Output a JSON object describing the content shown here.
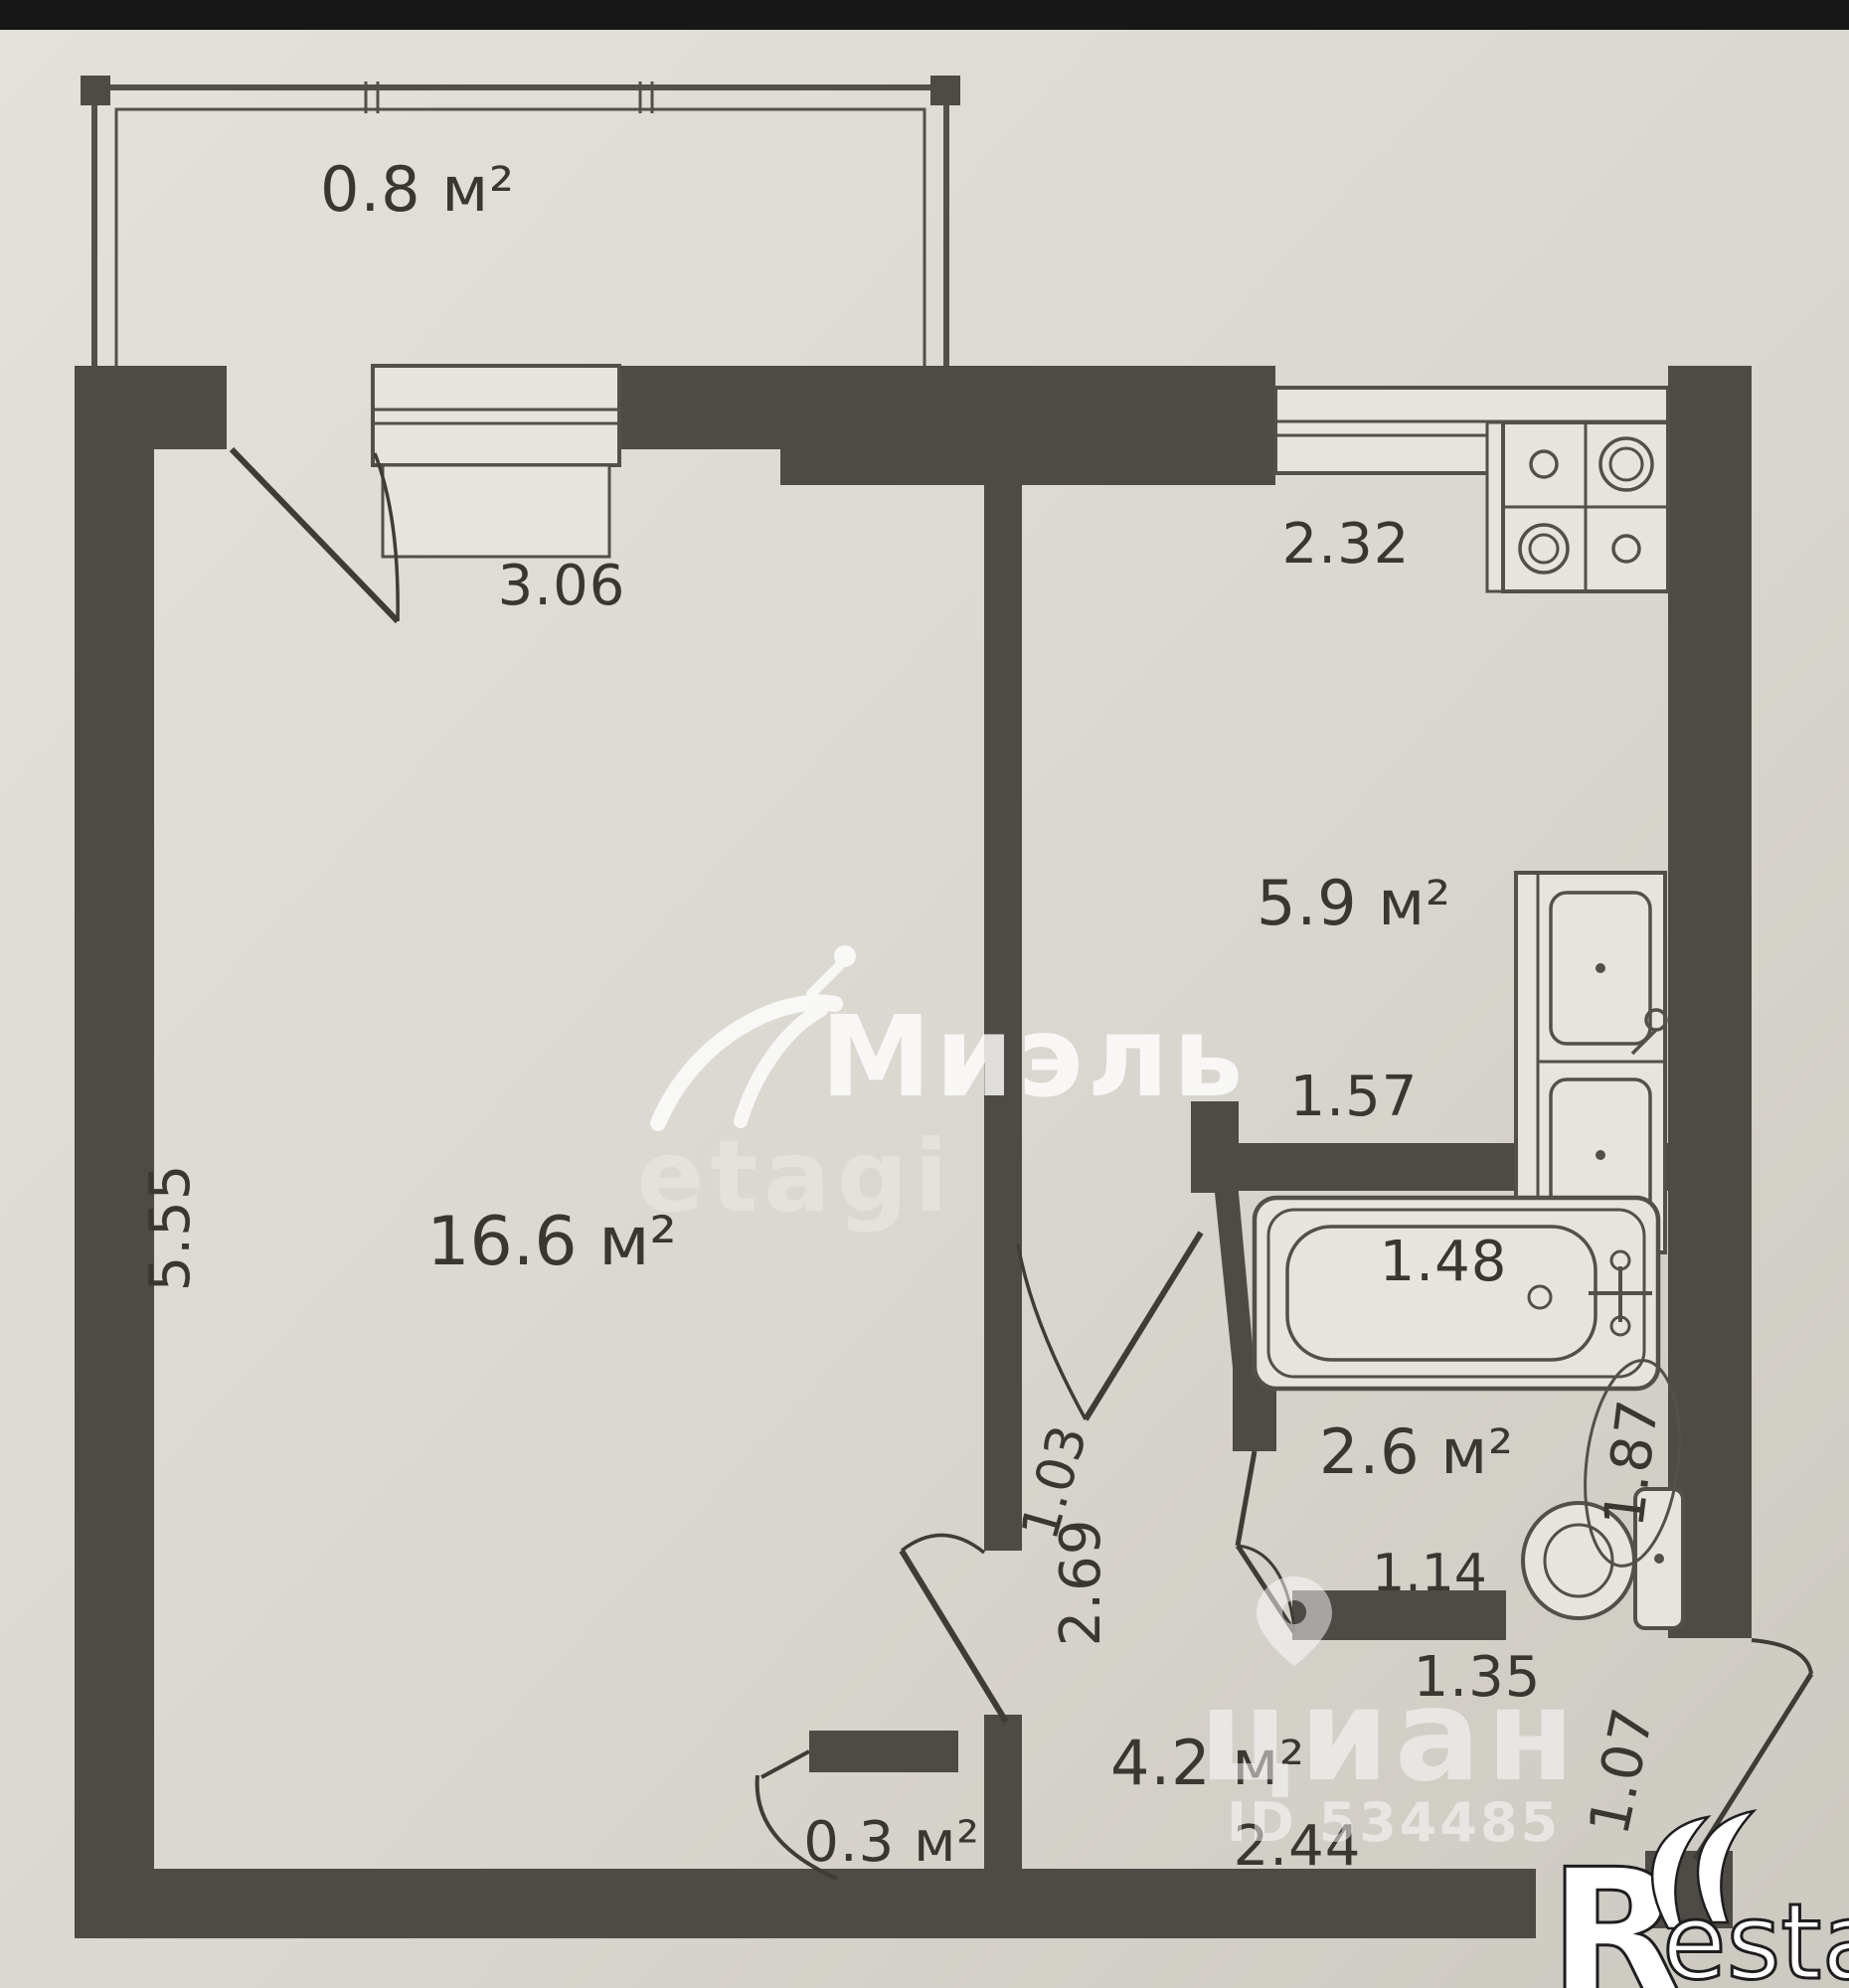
{
  "plan": {
    "type": "apartment-floor-plan-photo",
    "colors": {
      "wall": "#4e4a46",
      "line": "#53504b",
      "paper_light": "#e2dfd8",
      "paper_dark": "#cfccc4",
      "text": "#3a3733",
      "top_strip": "#171717"
    },
    "labels": {
      "balcony_area": "0.8 м²",
      "room_width": "3.06",
      "room_area": "16.6 м²",
      "room_height": "5.55",
      "kitchen_width": "2.32",
      "kitchen_area": "5.9 м²",
      "kitchen_depth": "1.57",
      "bath_length": "1.48",
      "bath_area": "2.6 м²",
      "bath_height": "1.87",
      "toilet_width": "1.14",
      "bath_wall": "1.03",
      "hall_height": "2.69",
      "hall_area": "4.2 м²",
      "hall_width": "2.44",
      "hall_nook": "1.35",
      "entry_width": "1.07",
      "closet_area": "0.3 м²"
    },
    "fixtures": [
      "stove",
      "kitchen-sink",
      "bathtub",
      "toilet"
    ],
    "watermarks": {
      "miel_brand": "Миэль",
      "miel_sub": "etagi",
      "cian_brand": "циан",
      "cian_id": "ID 534485",
      "restate_r": "R",
      "restate_rest": "estate"
    }
  }
}
